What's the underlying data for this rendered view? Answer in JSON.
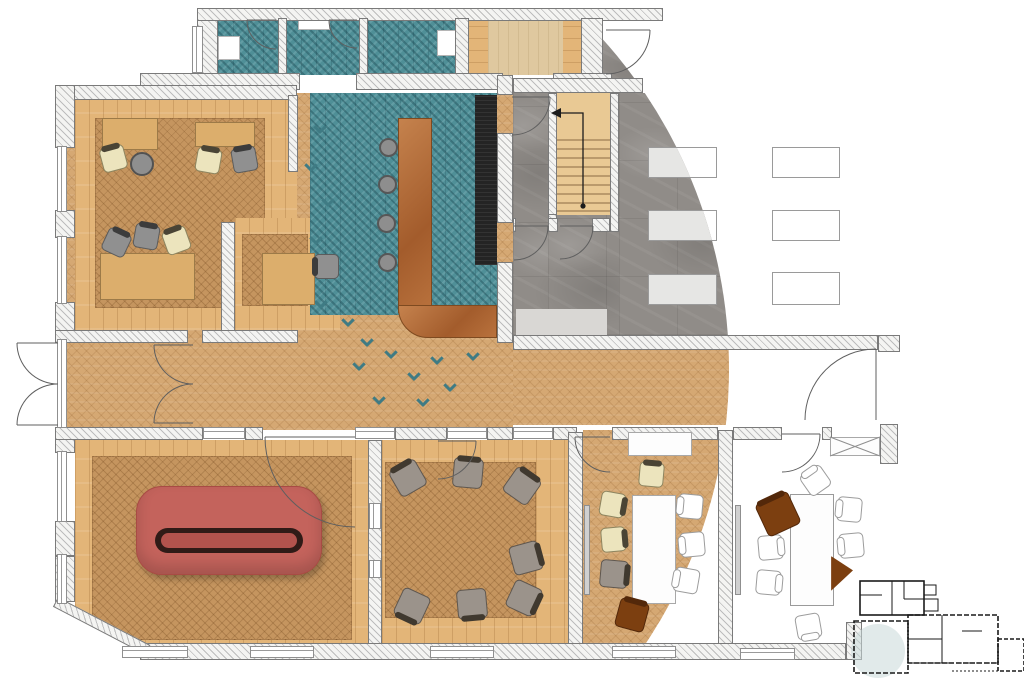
{
  "meta": {
    "type": "architectural-floor-plan",
    "view": "top-down rendered plan",
    "note": "colored render inside circular boundary, line drawing outside",
    "render_circle": {
      "cx": 235,
      "cy": 369,
      "r": 494
    }
  },
  "colors": {
    "wood1": "#d5a873",
    "wood2": "#c5955f",
    "plank": "#e3b578",
    "maple": "#dfc89f",
    "teal": "#4f8f97",
    "tealdark": "#3f7b84",
    "stone": "#908c88",
    "mat": "#d9d7d4",
    "black": "#242424",
    "copper1": "#c5824d",
    "copper2": "#a35c2c",
    "desk": "#dcae6c",
    "stairwood": "#e9c994",
    "sofa": "#c4635c",
    "sofaslot": "#301b17",
    "sofainner": "#b2534d",
    "cream": "#ece4bd",
    "graychair": "#909090",
    "taupe": "#9b938b",
    "brown": "#7c3f10",
    "tablefill": "#e6e6e4",
    "highlight": "#c9d8d8",
    "wallline": "#7a7a7a"
  },
  "rooms": [
    {
      "id": "open-plan-office",
      "floor": "oak herringbone rug on plank border",
      "furniture": "4 desks, 8 task chairs"
    },
    {
      "id": "bar-lounge",
      "floor": "teal herringbone tile blending into oak",
      "furniture": "L-shaped copper bar, 4 stools, black back counter"
    },
    {
      "id": "wc-1"
    },
    {
      "id": "wc-2"
    },
    {
      "id": "wc-3"
    },
    {
      "id": "storage-room",
      "floor": "maple"
    },
    {
      "id": "stairwell",
      "furniture": "timber stair with up-arrow"
    },
    {
      "id": "hall",
      "floor": "grey stone",
      "furniture": "6 rectangular tables"
    },
    {
      "id": "corridor",
      "floor": "oak herringbone"
    },
    {
      "id": "entrance-vestibule",
      "furniture": "double exterior + interior doors"
    },
    {
      "id": "lounge",
      "furniture": "large red conversation sofa"
    },
    {
      "id": "seminar-room",
      "furniture": "7 chairs around square rug"
    },
    {
      "id": "dining-room",
      "furniture": "white table, cream/brown chairs, sideboard"
    },
    {
      "id": "meeting-room",
      "furniture": "line-drawn table and chairs, 2 brown chairs, crossed cabinet"
    }
  ],
  "key_plan": {
    "buildings": 2,
    "highlight": "circular marker on current wing"
  }
}
